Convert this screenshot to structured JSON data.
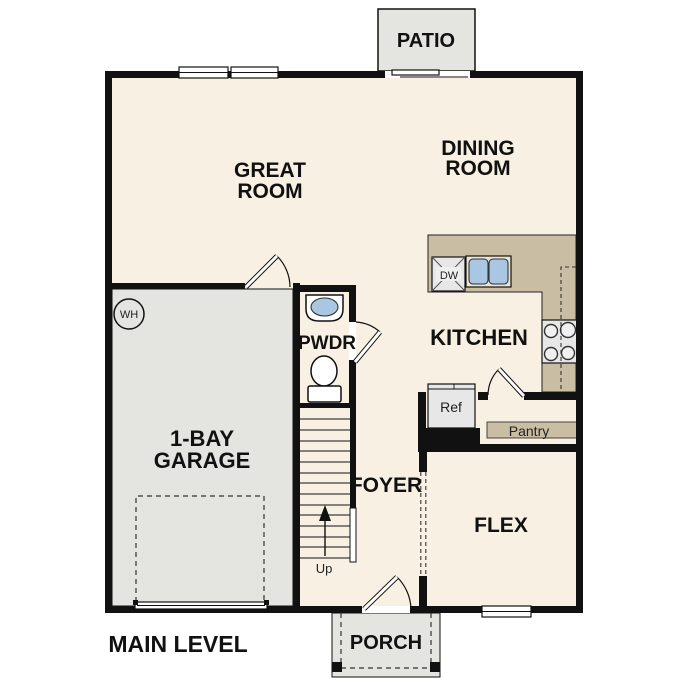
{
  "title": "MAIN LEVEL",
  "colors": {
    "wall": "#111111",
    "floor": "#f8f0e3",
    "outdoor": "#e4e4e1",
    "counter": "#c9bda3",
    "basin": "#a9c7e3",
    "appliance": "#e7e7e7",
    "text": "#111111"
  },
  "rooms": {
    "patio": {
      "label": "PATIO"
    },
    "great_room": {
      "lines": [
        "GREAT",
        "ROOM"
      ]
    },
    "dining_room": {
      "lines": [
        "DINING",
        "ROOM"
      ]
    },
    "kitchen": {
      "label": "KITCHEN"
    },
    "powder": {
      "label": "PWDR"
    },
    "foyer": {
      "label": "FOYER"
    },
    "flex": {
      "label": "FLEX"
    },
    "garage": {
      "lines": [
        "1-BAY",
        "GARAGE"
      ]
    },
    "porch": {
      "label": "PORCH"
    }
  },
  "fixtures": {
    "dishwasher": "DW",
    "pantry": "Pantry",
    "refrigerator": "Ref",
    "stairs_up": "Up",
    "water_heater": "WH"
  }
}
